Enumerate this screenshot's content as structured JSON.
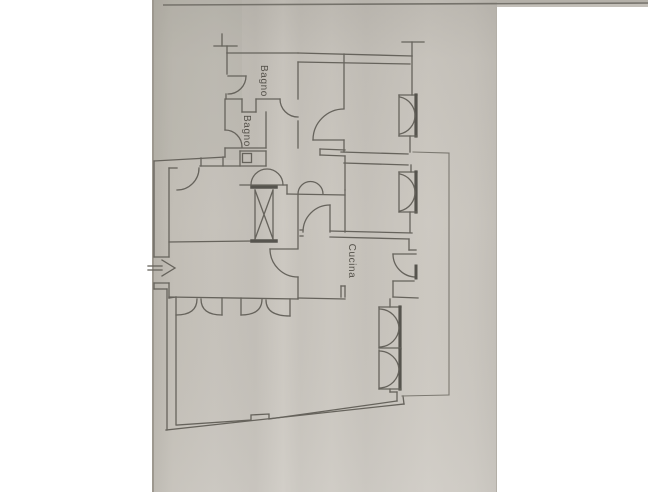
{
  "page": {
    "background_color": "#ffffff"
  },
  "gallery": {
    "previous_photo_edge": {
      "description": "bottom sliver of previous gallery photo",
      "paper_color": "#c3bfb8",
      "edge_line_color": "#6e6b64"
    }
  },
  "photo": {
    "description": "photograph of a paper floor plan (planimetria), plan rotated 90 degrees",
    "paper_color": "#c8c4bd",
    "paper_shadow_color": "#9d988f",
    "line_color": "#66635c",
    "thick_line_color": "#56544e",
    "floorplan": {
      "rooms": [
        {
          "label": "Bagno"
        },
        {
          "label": "Bagno"
        },
        {
          "label": "Cucina"
        }
      ],
      "symbols": [
        {
          "name": "entrance-arrow"
        },
        {
          "name": "stair-shaft-x"
        },
        {
          "name": "double-casement-windows"
        },
        {
          "name": "door-swing-arcs"
        },
        {
          "name": "terrace-outline"
        },
        {
          "name": "party-wall-ticks"
        }
      ]
    }
  }
}
